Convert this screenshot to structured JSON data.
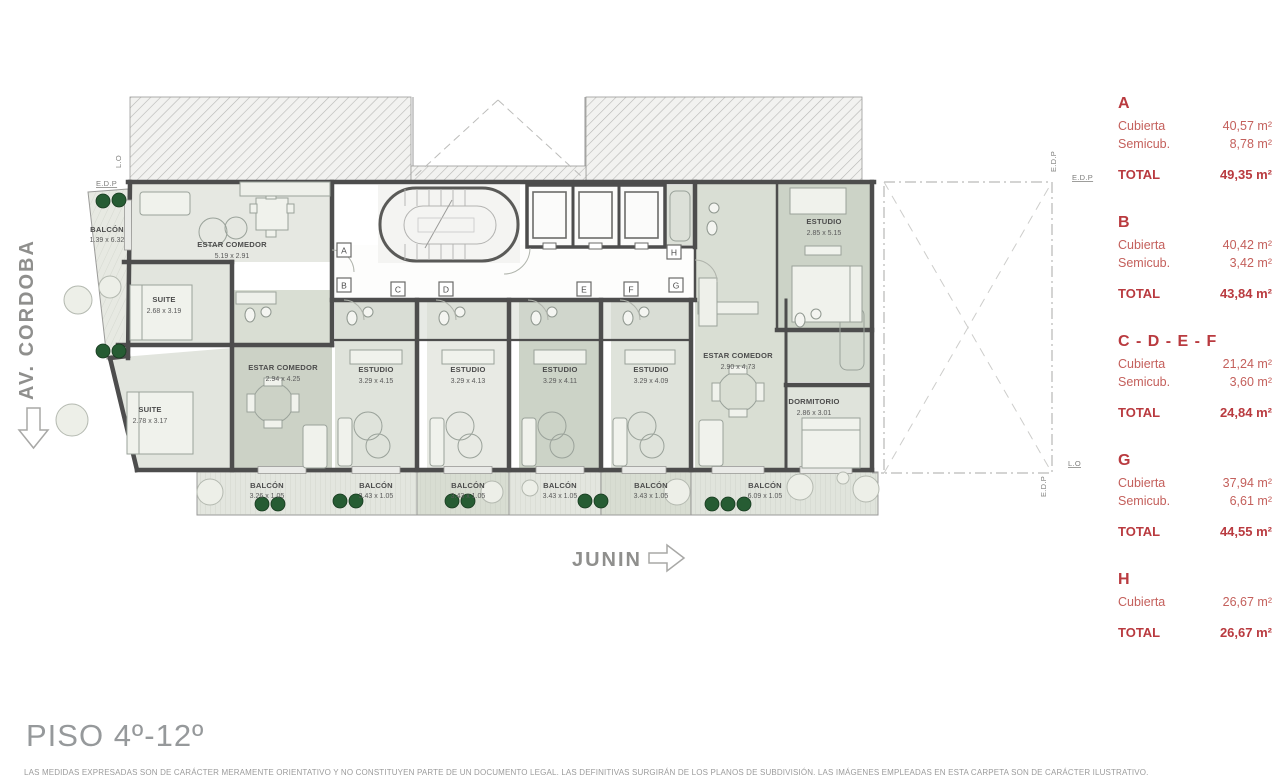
{
  "page": {
    "title": "PISO 4º-12º",
    "disclaimer": "LAS MEDIDAS EXPRESADAS SON DE CARÁCTER MERAMENTE ORIENTATIVO Y NO CONSTITUYEN PARTE DE UN DOCUMENTO LEGAL. LAS DEFINITIVAS SURGIRÁN DE LOS PLANOS DE SUBDIVISIÓN. LAS IMÁGENES EMPLEADAS EN ESTA CARPETA SON DE CARÁCTER ILUSTRATIVO."
  },
  "streets": {
    "left": "AV. CORDOBA",
    "bottom": "JUNIN"
  },
  "colors": {
    "accent_red": "#b93a3f",
    "accent_red_soft": "#c4605c",
    "wall": "#4d4d4d",
    "room_light": "#e4e7e0",
    "room_dark": "#ccd3c7",
    "plant_green": "#265c33",
    "title_gray": "#96999b"
  },
  "plan": {
    "site": {
      "edp": "E.D.P",
      "lo": "L.O"
    },
    "markers": [
      "A",
      "B",
      "C",
      "D",
      "E",
      "F",
      "G",
      "H"
    ],
    "rooms": [
      {
        "name": "BALCÓN",
        "dim": "1.39 x 6.32"
      },
      {
        "name": "ESTAR COMEDOR",
        "dim": "5.19 x 2.91"
      },
      {
        "name": "SUITE",
        "dim": "2.68 x 3.19"
      },
      {
        "name": "SUITE",
        "dim": "2.78 x 3.17"
      },
      {
        "name": "ESTAR COMEDOR",
        "dim": "2.94 x 4.25"
      },
      {
        "name": "ESTUDIO",
        "dim": "3.29 x 4.15"
      },
      {
        "name": "ESTUDIO",
        "dim": "3.29 x 4.13"
      },
      {
        "name": "ESTUDIO",
        "dim": "3.29 x 4.11"
      },
      {
        "name": "ESTUDIO",
        "dim": "3.29 x 4.09"
      },
      {
        "name": "ESTAR COMEDOR",
        "dim": "2.90 x 4.73"
      },
      {
        "name": "DORMITORIO",
        "dim": "2.86 x 3.01"
      },
      {
        "name": "ESTUDIO",
        "dim": "2.85 x 5.15"
      },
      {
        "name": "BALCÓN",
        "dim": "3.26 x 1.05"
      },
      {
        "name": "BALCÓN",
        "dim": "3.43 x 1.05"
      },
      {
        "name": "BALCÓN",
        "dim": "3.43 x 1.05"
      },
      {
        "name": "BALCÓN",
        "dim": "3.43 x 1.05"
      },
      {
        "name": "BALCÓN",
        "dim": "3.43 x 1.05"
      },
      {
        "name": "BALCÓN",
        "dim": "6.09 x 1.05"
      }
    ]
  },
  "legend": {
    "units": [
      {
        "name": "A",
        "rows": [
          {
            "label": "Cubierta",
            "value": "40,57 m²"
          },
          {
            "label": "Semicub.",
            "value": "8,78 m²"
          }
        ],
        "total_label": "TOTAL",
        "total": "49,35 m²"
      },
      {
        "name": "B",
        "rows": [
          {
            "label": "Cubierta",
            "value": "40,42 m²"
          },
          {
            "label": "Semicub.",
            "value": "3,42 m²"
          }
        ],
        "total_label": "TOTAL",
        "total": "43,84 m²"
      },
      {
        "name": "C - D - E - F",
        "rows": [
          {
            "label": "Cubierta",
            "value": "21,24 m²"
          },
          {
            "label": "Semicub.",
            "value": "3,60 m²"
          }
        ],
        "total_label": "TOTAL",
        "total": "24,84 m²"
      },
      {
        "name": "G",
        "rows": [
          {
            "label": "Cubierta",
            "value": "37,94 m²"
          },
          {
            "label": "Semicub.",
            "value": "6,61 m²"
          }
        ],
        "total_label": "TOTAL",
        "total": "44,55 m²"
      },
      {
        "name": "H",
        "rows": [
          {
            "label": "Cubierta",
            "value": "26,67 m²"
          }
        ],
        "total_label": "TOTAL",
        "total": "26,67 m²"
      }
    ]
  }
}
